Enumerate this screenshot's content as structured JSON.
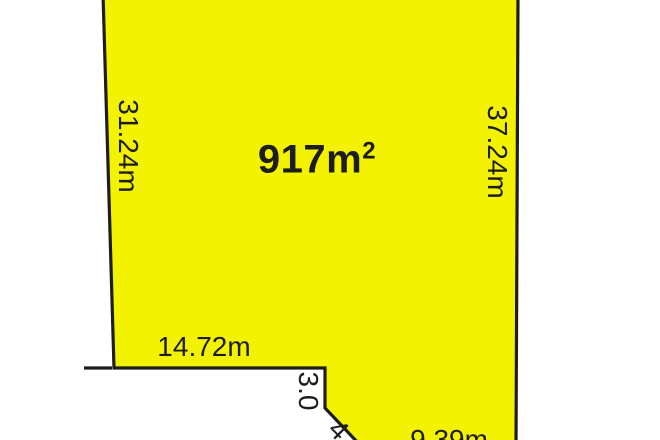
{
  "diagram": {
    "type": "property-lot-plan",
    "background_color": "#ffffff",
    "lot": {
      "fill_color": "#f3f301",
      "outline_color": "#1d1d1d",
      "text_color": "#1d1d1d",
      "area": {
        "value": "917m",
        "superscript": "2"
      },
      "dimensions": {
        "left_side": "31.24m",
        "right_side": "37.24m",
        "bottom": "14.72m",
        "step": "3.0",
        "splay": "4.",
        "bottom_right": "9.39m"
      }
    }
  }
}
